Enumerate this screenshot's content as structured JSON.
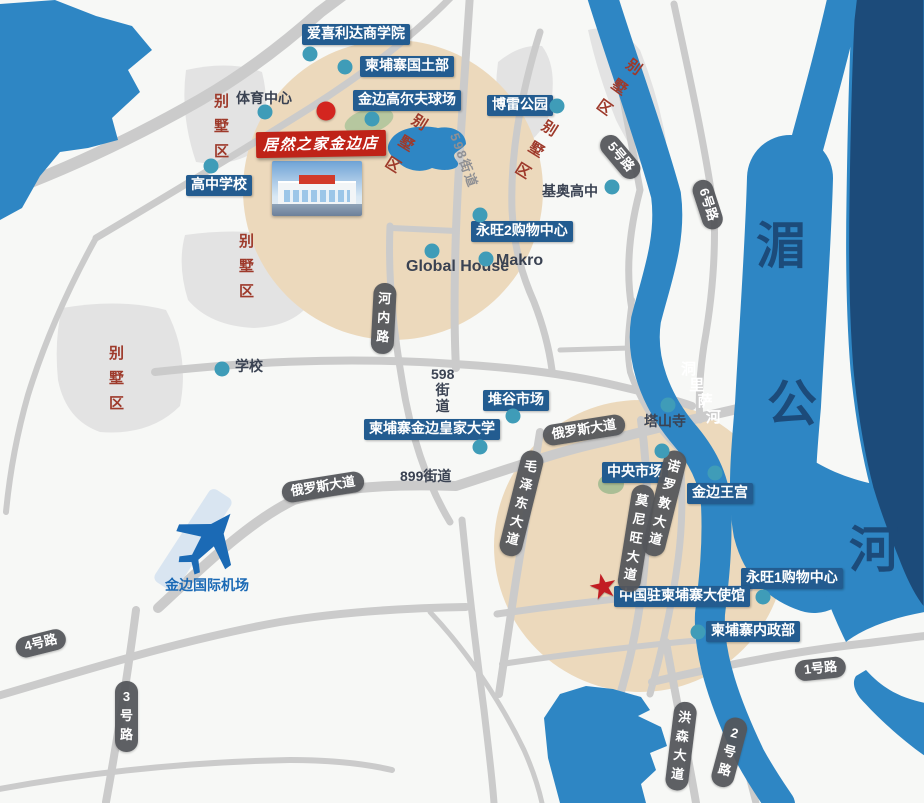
{
  "map": {
    "colors": {
      "water": "#2e86c4",
      "water_dark": "#1c4b7a",
      "land_circle": "#ecd9bc",
      "road": "#cbcbcb",
      "district_fill": "#e3e3e3",
      "poi_box": "#235c90",
      "store_box": "#bf2318",
      "district_text": "#9e3a2b",
      "road_pill": "#54565a",
      "dot": "#3f9cb8",
      "red_marker": "#d3251f",
      "mekong_text": "#1c4b7a"
    },
    "store": {
      "label": "居然之家金边店",
      "x": 256,
      "y": 131
    },
    "poi_labels": [
      {
        "t": "爱喜利达商学院",
        "x": 302,
        "y": 24
      },
      {
        "t": "柬埔寨国土部",
        "x": 360,
        "y": 56
      },
      {
        "t": "金边高尔夫球场",
        "x": 353,
        "y": 90
      },
      {
        "t": "博雷公园",
        "x": 487,
        "y": 95
      },
      {
        "t": "高中学校",
        "x": 186,
        "y": 175
      },
      {
        "t": "永旺2购物中心",
        "x": 471,
        "y": 221
      },
      {
        "t": "堆谷市场",
        "x": 483,
        "y": 390
      },
      {
        "t": "柬埔寨金边皇家大学",
        "x": 364,
        "y": 419
      },
      {
        "t": "中央市场",
        "x": 602,
        "y": 462
      },
      {
        "t": "金边王宫",
        "x": 687,
        "y": 483
      },
      {
        "t": "永旺1购物中心",
        "x": 741,
        "y": 568
      },
      {
        "t": "中国驻柬埔寨大使馆",
        "x": 614,
        "y": 586
      },
      {
        "t": "柬埔寨内政部",
        "x": 706,
        "y": 621
      }
    ],
    "plain_labels": [
      {
        "t": "体育中心",
        "x": 236,
        "y": 88,
        "c": "dark"
      },
      {
        "t": "基奥高中",
        "x": 542,
        "y": 181,
        "c": "dark"
      },
      {
        "t": "Global House",
        "x": 406,
        "y": 258,
        "c": "dark",
        "big": 1
      },
      {
        "t": "Makro",
        "x": 496,
        "y": 252,
        "c": "dark",
        "big": 1
      },
      {
        "t": "学校",
        "x": 235,
        "y": 356,
        "c": "dark"
      },
      {
        "t": "塔山寺",
        "x": 644,
        "y": 411,
        "c": "dark"
      },
      {
        "t": "899街道",
        "x": 400,
        "y": 466,
        "c": "dark"
      },
      {
        "t": "金边国际机场",
        "x": 165,
        "y": 575,
        "c": "blue"
      }
    ],
    "district_word": "别墅区",
    "districts": [
      {
        "x": 213,
        "y": 90,
        "r": 0
      },
      {
        "x": 417,
        "y": 113,
        "r": 32
      },
      {
        "x": 547,
        "y": 119,
        "r": 32
      },
      {
        "x": 632,
        "y": 58,
        "r": 36
      },
      {
        "x": 238,
        "y": 230,
        "r": 0
      },
      {
        "x": 108,
        "y": 342,
        "r": 0
      }
    ],
    "road_pills": [
      {
        "t": "5号路",
        "x": 604,
        "y": 127,
        "r": 50,
        "v": 0
      },
      {
        "t": "6号路",
        "x": 700,
        "y": 170,
        "r": 72,
        "v": 0
      },
      {
        "t": "河内路",
        "x": 374,
        "y": 283,
        "r": 3,
        "v": 1
      },
      {
        "t": "俄罗斯大道",
        "x": 282,
        "y": 483,
        "r": -9,
        "v": 0
      },
      {
        "t": "俄罗斯大道",
        "x": 543,
        "y": 426,
        "r": -9,
        "v": 0
      },
      {
        "t": "毛泽东大道",
        "x": 523,
        "y": 451,
        "r": 14,
        "v": 1
      },
      {
        "t": "诺罗敦大道",
        "x": 666,
        "y": 451,
        "r": 14,
        "v": 1
      },
      {
        "t": "莫尼旺大道",
        "x": 633,
        "y": 485,
        "r": 9,
        "v": 1
      },
      {
        "t": "4号路",
        "x": 16,
        "y": 639,
        "r": -14,
        "v": 0
      },
      {
        "t": "3号路",
        "x": 115,
        "y": 681,
        "r": 0,
        "v": 1
      },
      {
        "t": "1号路",
        "x": 795,
        "y": 661,
        "r": -6,
        "v": 0
      },
      {
        "t": "2号路",
        "x": 727,
        "y": 718,
        "r": 15,
        "v": 1
      },
      {
        "t": "洪森大道",
        "x": 675,
        "y": 702,
        "r": 7,
        "v": 1
      }
    ],
    "street_texts": [
      {
        "t": "598街道",
        "x": 464,
        "y": 130,
        "r": 70,
        "c": "#8f9094",
        "fs": 13
      },
      {
        "lines": [
          "598",
          "街",
          "道"
        ],
        "x": 431,
        "y": 366,
        "c": "#3c4454",
        "fs": 14
      },
      {
        "t": "洞里萨河",
        "x": 681,
        "y": 362,
        "dx": 8.3,
        "dy": 16,
        "c": "#ffffff"
      }
    ],
    "mekong_chars": [
      {
        "t": "湄",
        "x": 756,
        "y": 221
      },
      {
        "t": "公",
        "x": 767,
        "y": 379
      },
      {
        "t": "河",
        "x": 849,
        "y": 525
      }
    ],
    "dots": [
      [
        310,
        54
      ],
      [
        345,
        67
      ],
      [
        265,
        112
      ],
      [
        211,
        166
      ],
      [
        372,
        119
      ],
      [
        557,
        106
      ],
      [
        612,
        187
      ],
      [
        480,
        215
      ],
      [
        432,
        251
      ],
      [
        486,
        259
      ],
      [
        222,
        369
      ],
      [
        513,
        416
      ],
      [
        480,
        447
      ],
      [
        668,
        405
      ],
      [
        662,
        451
      ],
      [
        715,
        473
      ],
      [
        763,
        597
      ],
      [
        698,
        632
      ]
    ],
    "red_dot": {
      "x": 326,
      "y": 111
    },
    "star": {
      "x": 588,
      "y": 570,
      "glyph": "★"
    }
  }
}
